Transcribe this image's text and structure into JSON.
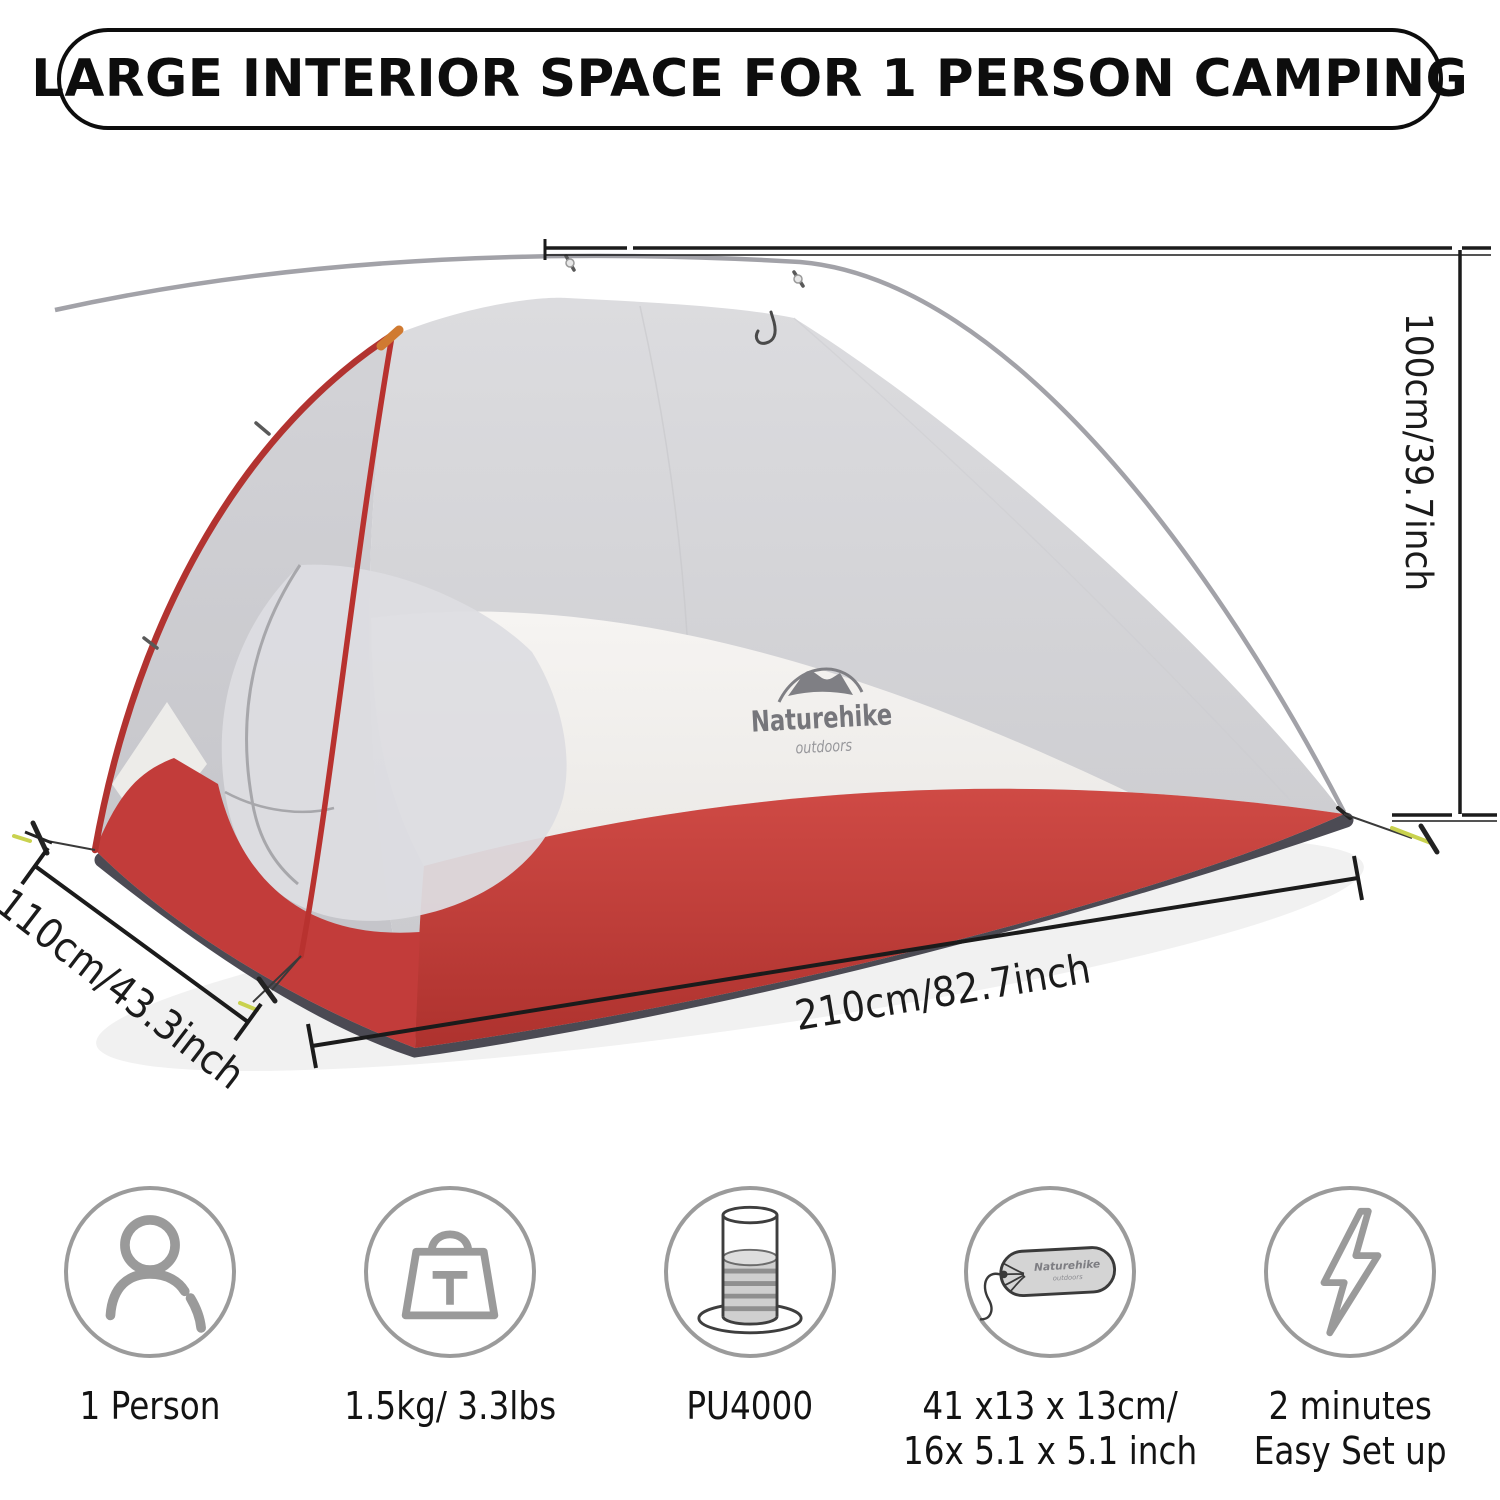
{
  "banner": {
    "title": "LARGE INTERIOR SPACE FOR 1 PERSON CAMPING"
  },
  "product": {
    "brand": "Naturehike",
    "brand_tagline": "outdoors"
  },
  "dimensions": {
    "height_label": "100cm/39.7inch",
    "depth_label": "110cm/43.3inch",
    "length_label": "210cm/82.7inch"
  },
  "features": [
    {
      "icon": "person-icon",
      "line1": "1 Person",
      "line2": ""
    },
    {
      "icon": "weight-icon",
      "line1": "1.5kg/ 3.3lbs",
      "line2": ""
    },
    {
      "icon": "waterproof-rating-icon",
      "line1": "PU4000",
      "line2": ""
    },
    {
      "icon": "packed-size-icon",
      "line1": "41 x13 x 13cm/",
      "line2": "16x 5.1 x 5.1 inch"
    },
    {
      "icon": "setup-time-icon",
      "line1": "2 minutes",
      "line2": "Easy Set up"
    }
  ],
  "colors": {
    "tent_red": "#c2403c",
    "mesh_gray": "#d6d6d9",
    "fly_white": "#f3f1ef",
    "pole_red": "#b23330",
    "pole_silver": "#a2a2a8",
    "icon_gray": "#9a9a9a",
    "line_black": "#1b1b1b"
  }
}
